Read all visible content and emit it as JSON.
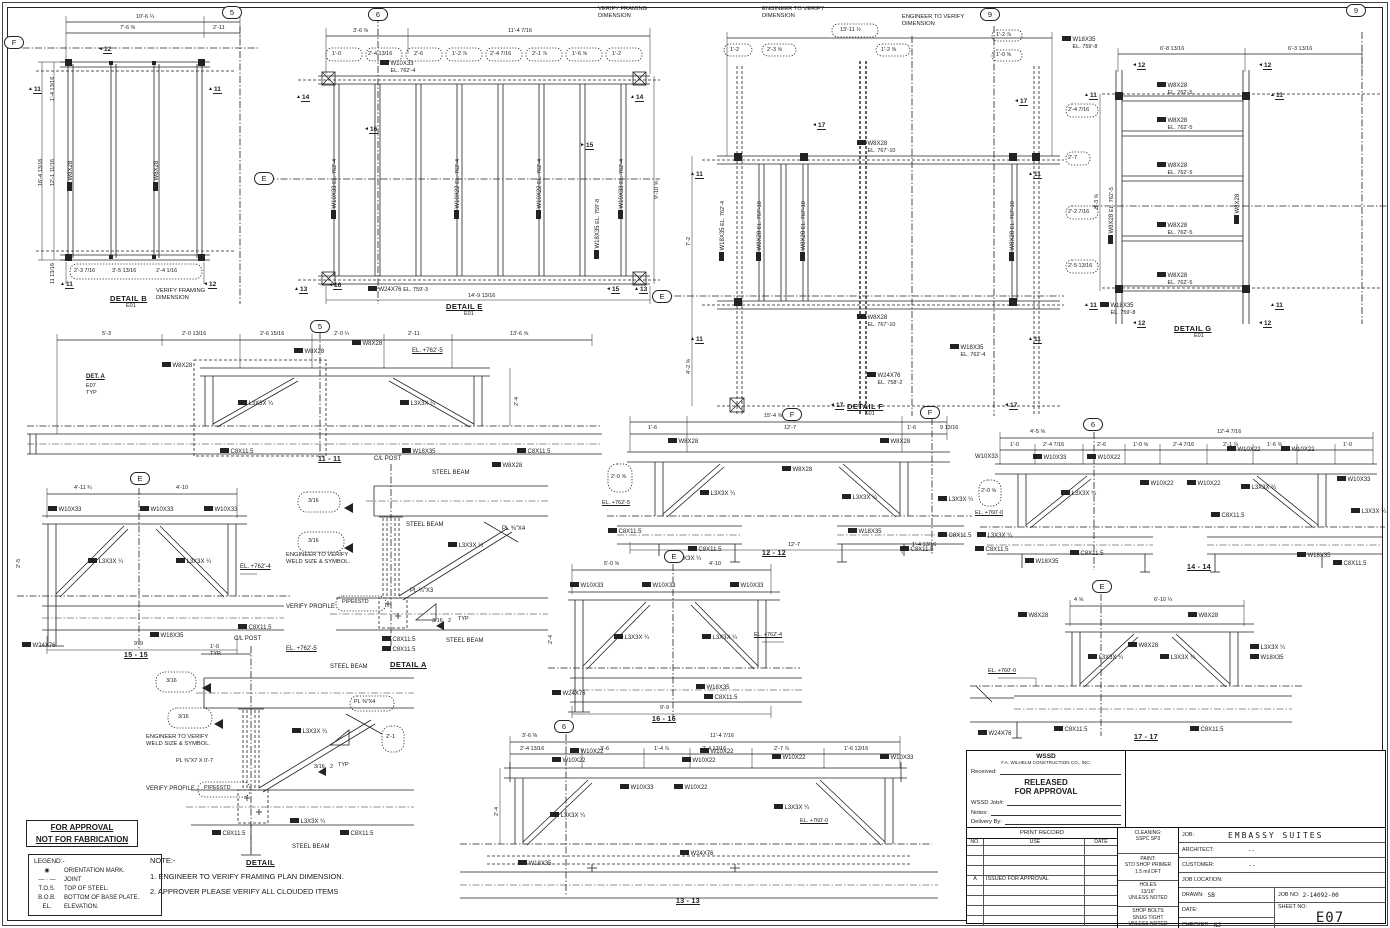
{
  "shared": {
    "grid": {
      "g5": "5",
      "g6": "6",
      "g9": "9",
      "gE": "E",
      "gF": "F"
    },
    "sec": {
      "s11": "11",
      "s12": "12",
      "s13": "13",
      "s14": "14",
      "s15": "15",
      "s16": "16",
      "s17": "17"
    },
    "beams": {
      "w8x28": "W8X28",
      "w10x33": "W10X33",
      "w10x22": "W10X22",
      "w18x35": "W18X35",
      "w24x76": "W24X76",
      "c8": "C8X11.5",
      "l3": "L3X3X ¼",
      "pipe": "PIPE6STD"
    },
    "callouts": {
      "verify_framing_1": "VERIFY FRAMING",
      "verify_framing_2": "DIMENSION",
      "eng_dim_1": "ENGINEER TO VERIFY",
      "eng_dim_2": "DIMENSION",
      "eng_weld_1": "ENGINEER TO VERIFY",
      "eng_weld_2": "WELD SIZE & SYMBOL.",
      "verify_profile": "VERIFY PROFILE",
      "steel_beam": "STEEL BEAM",
      "cl_post": "C/L POST",
      "typ": "TYP",
      "typ_dot": "TYP.",
      "weld": "3/16"
    }
  },
  "panels": {
    "detail_b": {
      "title": "DETAIL B",
      "ref": "E01",
      "dims": {
        "top": "10'-6 ¼",
        "top_a": "7'-6 ⅜",
        "top_b": "2'-11",
        "left": "16'-4 13/16",
        "left_a": "12'-1 11/16",
        "left_b": "1'-4 13/16",
        "left_c": "11 13/16",
        "cloud_a": "2'-3 7/16",
        "cloud_b": "3'-5 13/16",
        "cloud_c": "2'-4 1/16"
      }
    },
    "detail_e": {
      "title": "DETAIL E",
      "ref": "E01",
      "el_beam": "EL. 762'-4",
      "el_girder": "EL. 759'-3",
      "el_w18": "EL. 759'-8",
      "dims": {
        "top_a": "3'-6 ⅜",
        "top_b": "11'-4 7/16",
        "bottom": "14'-9 13/16",
        "right": "9'-10 ⅝",
        "c1": "1'-0",
        "c2": "2'-4 13/16",
        "c3": "2'-6",
        "c4": "1'-2 ⅞",
        "c5": "2'-4 7/16",
        "c6": "2'-1 ⅞",
        "c7": "1'-6 ⅝",
        "c8": "1'-2"
      }
    },
    "detail_f": {
      "title": "DETAIL F",
      "ref": "E01",
      "el_beam": "EL. 767'-10",
      "el_w18": "EL. 762'-4",
      "el_girder": "EL. 758'-2",
      "dims": {
        "cloud_top": "13'-11 ½",
        "c1": "1'-2",
        "c2": "2'-3 ⅝",
        "c3": "1'-2 ⅝",
        "c4": "1'-2 ⅞",
        "c5": "1'-0 ⅝",
        "left_a": "7'-2",
        "left_b": "4'-2 ⅝"
      }
    },
    "detail_g": {
      "title": "DETAIL G",
      "ref": "E01",
      "el_beam": "EL. 762'-5",
      "el_w18": "EL. 759'-8",
      "dims": {
        "top_a": "6'-8 13/16",
        "top_b": "6'-3 13/16",
        "left": "8'-3 ⅝",
        "c1": "2'-4 7/16",
        "c2": "2'-7",
        "c3": "2'-2 7/16",
        "c4": "2'-5 13/16"
      }
    },
    "s11": {
      "title": "11 - 11",
      "el": "EL. +762'-5",
      "det_a": "DET. A",
      "det_a_ref": "E07",
      "det_a_typ": "TYP",
      "dims": {
        "d1": "5'-3",
        "d2": "2'-0 13/16",
        "d3": "2'-6 15/16",
        "d4": "2'-0 ¼",
        "d5": "2'-11",
        "d6": "13'-6 ⅝",
        "h": "2'-4"
      }
    },
    "s12": {
      "title": "12 - 12",
      "el": "EL. +762'-5",
      "dims": {
        "top": "15'-4 ⅜",
        "d1": "1'-6",
        "d2": "12'-7",
        "d3": "1'-6",
        "d4": "9 13/16",
        "b1": "12'-7",
        "b2": "1'-4 13/16",
        "cloud": "2'-0 ⅝"
      }
    },
    "s13": {
      "title": "13 - 13",
      "el": "EL. +760'-0",
      "dims": {
        "top_a": "3'-6 ⅜",
        "top_b": "11'-4 7/16",
        "s1": "2'-4 13/16",
        "s2": "3'-6",
        "s3": "1'-4 ⅞",
        "s4": "2'-4 13/16",
        "s5": "2'-7 ⅞",
        "s6": "1'-6 13/16",
        "h": "2'-4"
      }
    },
    "s14": {
      "title": "14 - 14",
      "el": "EL. +760'-0",
      "dims": {
        "top_a": "4'-5 ⅜",
        "top_b": "12'-4 7/16",
        "s1": "1'-0",
        "s2": "2'-4 7/16",
        "s3": "2'-6",
        "s4": "1'-0 ⅝",
        "s5": "2'-4 7/16",
        "s6": "2'-1 ⅞",
        "s7": "1'-6 ⅝",
        "s8": "1'-0",
        "cloud": "2'-0 ⅝"
      }
    },
    "s15": {
      "title": "15 - 15",
      "el": "EL. +762'-4",
      "dims": {
        "top_a": "4'-11 ¾",
        "top_b": "4'-10",
        "bottom": "9'-9",
        "h": "2'-5"
      }
    },
    "s16": {
      "title": "16 - 16",
      "el": "EL. +762'-4",
      "dims": {
        "top_a": "5'-0 ⅝",
        "top_b": "4'-10",
        "bottom": "9'-9",
        "h": "2'-4"
      }
    },
    "s17": {
      "title": "17 - 17",
      "el": "EL. +760'-0",
      "dims": {
        "top_a": "4 ⅝",
        "top_b": "6'-10 ¼"
      }
    },
    "detail_a": {
      "title": "DETAIL A",
      "pl_top": "PL ⅜\"X4",
      "pl_bot": "PL ¼\"X3",
      "weld_b": "2"
    },
    "detail_btm": {
      "title": "DETAIL",
      "dim_a": "1'-0",
      "el": "EL. +762'-5",
      "pl_cap": "PL ⅜\"X7 X 0'-7",
      "pl_gusset": "PL ⅜\"X4",
      "weld_b": "2",
      "cloud_dim": "2'-1"
    }
  },
  "stamp": {
    "line1": "FOR APPROVAL",
    "line2": "NOT FOR FABRICATION"
  },
  "legend": {
    "title": "LEGEND:-",
    "items": [
      {
        "sym": "◉",
        "label": "ORIENTATION MARK."
      },
      {
        "sym": "— · —",
        "label": "JOINT"
      },
      {
        "sym": "T.O.S.",
        "label": "TOP OF STEEL."
      },
      {
        "sym": "B.O.B.",
        "label": "BOTTOM OF BASE PLATE."
      },
      {
        "sym": "EL.",
        "label": "ELEVATION."
      }
    ]
  },
  "note_block": {
    "title": "NOTE:-",
    "n1": "1. ENGINEER TO VERIFY FRAMING PLAN DIMENSION.",
    "n2": "2. APPROVER PLEASE VERIFY ALL CLOUDED ITEMS"
  },
  "titleblock": {
    "company": "WSSD",
    "company_sub": "F.A. WILHELM CONSTRUCTION CO., INC.",
    "received_label": "Received:",
    "released_line1": "RELEASED",
    "released_line2": "FOR APPROVAL",
    "wssd_job_label": "WSSD Job#:",
    "notes_label": "Notes:",
    "delivery_label": "Delivery By:",
    "print_record_title": "PRINT RECORD",
    "col_no": "NO.",
    "col_use": "USE",
    "col_date": "DATE",
    "rev_a": "A",
    "rev_a_desc": "ISSUED FOR APPROVAL",
    "cleaning_label": "CLEANING:",
    "cleaning_value": "SSPC SP3",
    "paint_label": "PAINT:",
    "paint_value_1": "STD SHOP PRIMER",
    "paint_value_2": "1.5 mil DFT",
    "holes_1": "HOLES",
    "holes_2": "13/16\"",
    "holes_3": "UNLESS NOTED",
    "bolts_1": "SHOP BOLTS",
    "bolts_2": "SNUG TIGHT",
    "bolts_3": "UNLESS NOTED",
    "job_label": "JOB:",
    "job_value": "EMBASSY SUITES",
    "architect_label": "ARCHITECT:",
    "architect_value": "--",
    "customer_label": "CUSTOMER:",
    "customer_value": "--",
    "job_location_label": "JOB LOCATION:",
    "drawn_label": "DRAWN:",
    "drawn_value": "SB",
    "date_label": "DATE:",
    "checked_label": "CHECKED:",
    "checked_value": "NJ",
    "job_no_label": "JOB NO:",
    "job_no_value": "2-14092-00",
    "sheet_no_label": "SHEET NO:",
    "sheet_no_value": "E07"
  }
}
